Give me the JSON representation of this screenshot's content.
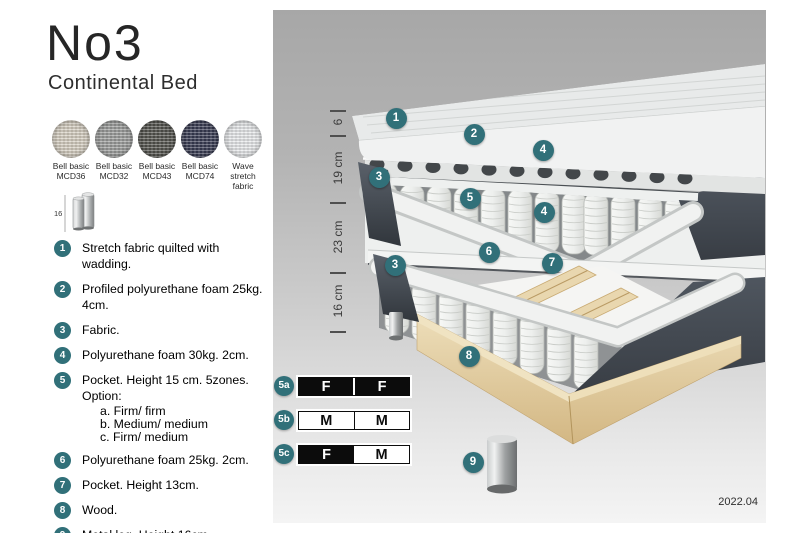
{
  "title": "No3",
  "subtitle": "Continental Bed",
  "swatches": [
    {
      "line1": "Bell basic",
      "line2": "MCD36",
      "color": "#d6cfc1"
    },
    {
      "line1": "Bell basic",
      "line2": "MCD32",
      "color": "#9c9d9c"
    },
    {
      "line1": "Bell basic",
      "line2": "MCD43",
      "color": "#54544f"
    },
    {
      "line1": "Bell basic",
      "line2": "MCD74",
      "color": "#3a3d54"
    },
    {
      "line1": "Wave",
      "line2": "stretch fabric",
      "color": "#e8eaec"
    }
  ],
  "leg_icon_label": "16",
  "legend": {
    "items": [
      {
        "num": "1",
        "text": "Stretch fabric quilted with wadding."
      },
      {
        "num": "2",
        "text": "Profiled polyurethane foam 25kg. 4cm."
      },
      {
        "num": "3",
        "text": "Fabric."
      },
      {
        "num": "4",
        "text": "Polyurethane foam 30kg. 2cm."
      },
      {
        "num": "5",
        "text": "Pocket. Height 15 cm. 5zones. Option:",
        "options": [
          "a. Firm/ firm",
          "b. Medium/ medium",
          "c. Firm/ medium"
        ]
      },
      {
        "num": "6",
        "text": "Polyurethane foam 25kg. 2cm."
      },
      {
        "num": "7",
        "text": "Pocket. Height 13cm."
      },
      {
        "num": "8",
        "text": "Wood."
      },
      {
        "num": "9",
        "text": "Metal leg. Height 16cm."
      }
    ]
  },
  "diagram": {
    "dimensions": [
      "6",
      "19 cm",
      "23 cm",
      "16 cm"
    ],
    "callouts": [
      "1",
      "2",
      "3",
      "4",
      "5",
      "4",
      "6",
      "3",
      "7",
      "8",
      "9"
    ],
    "firmness_rows": [
      {
        "id": "5a",
        "cells": [
          {
            "letter": "F",
            "dark": true
          },
          {
            "letter": "F",
            "dark": true
          }
        ]
      },
      {
        "id": "5b",
        "cells": [
          {
            "letter": "M",
            "dark": false
          },
          {
            "letter": "M",
            "dark": false
          }
        ]
      },
      {
        "id": "5c",
        "cells": [
          {
            "letter": "F",
            "dark": true
          },
          {
            "letter": "M",
            "dark": false
          }
        ]
      }
    ],
    "version": "2022.04"
  },
  "colors": {
    "accent_teal": "#317079",
    "panel_top": "#a7a7a7",
    "panel_bottom": "#f4f4f4",
    "bar_black": "#0c0c0c",
    "wood": "#e9d7af",
    "dark_fabric": "#454b54"
  }
}
